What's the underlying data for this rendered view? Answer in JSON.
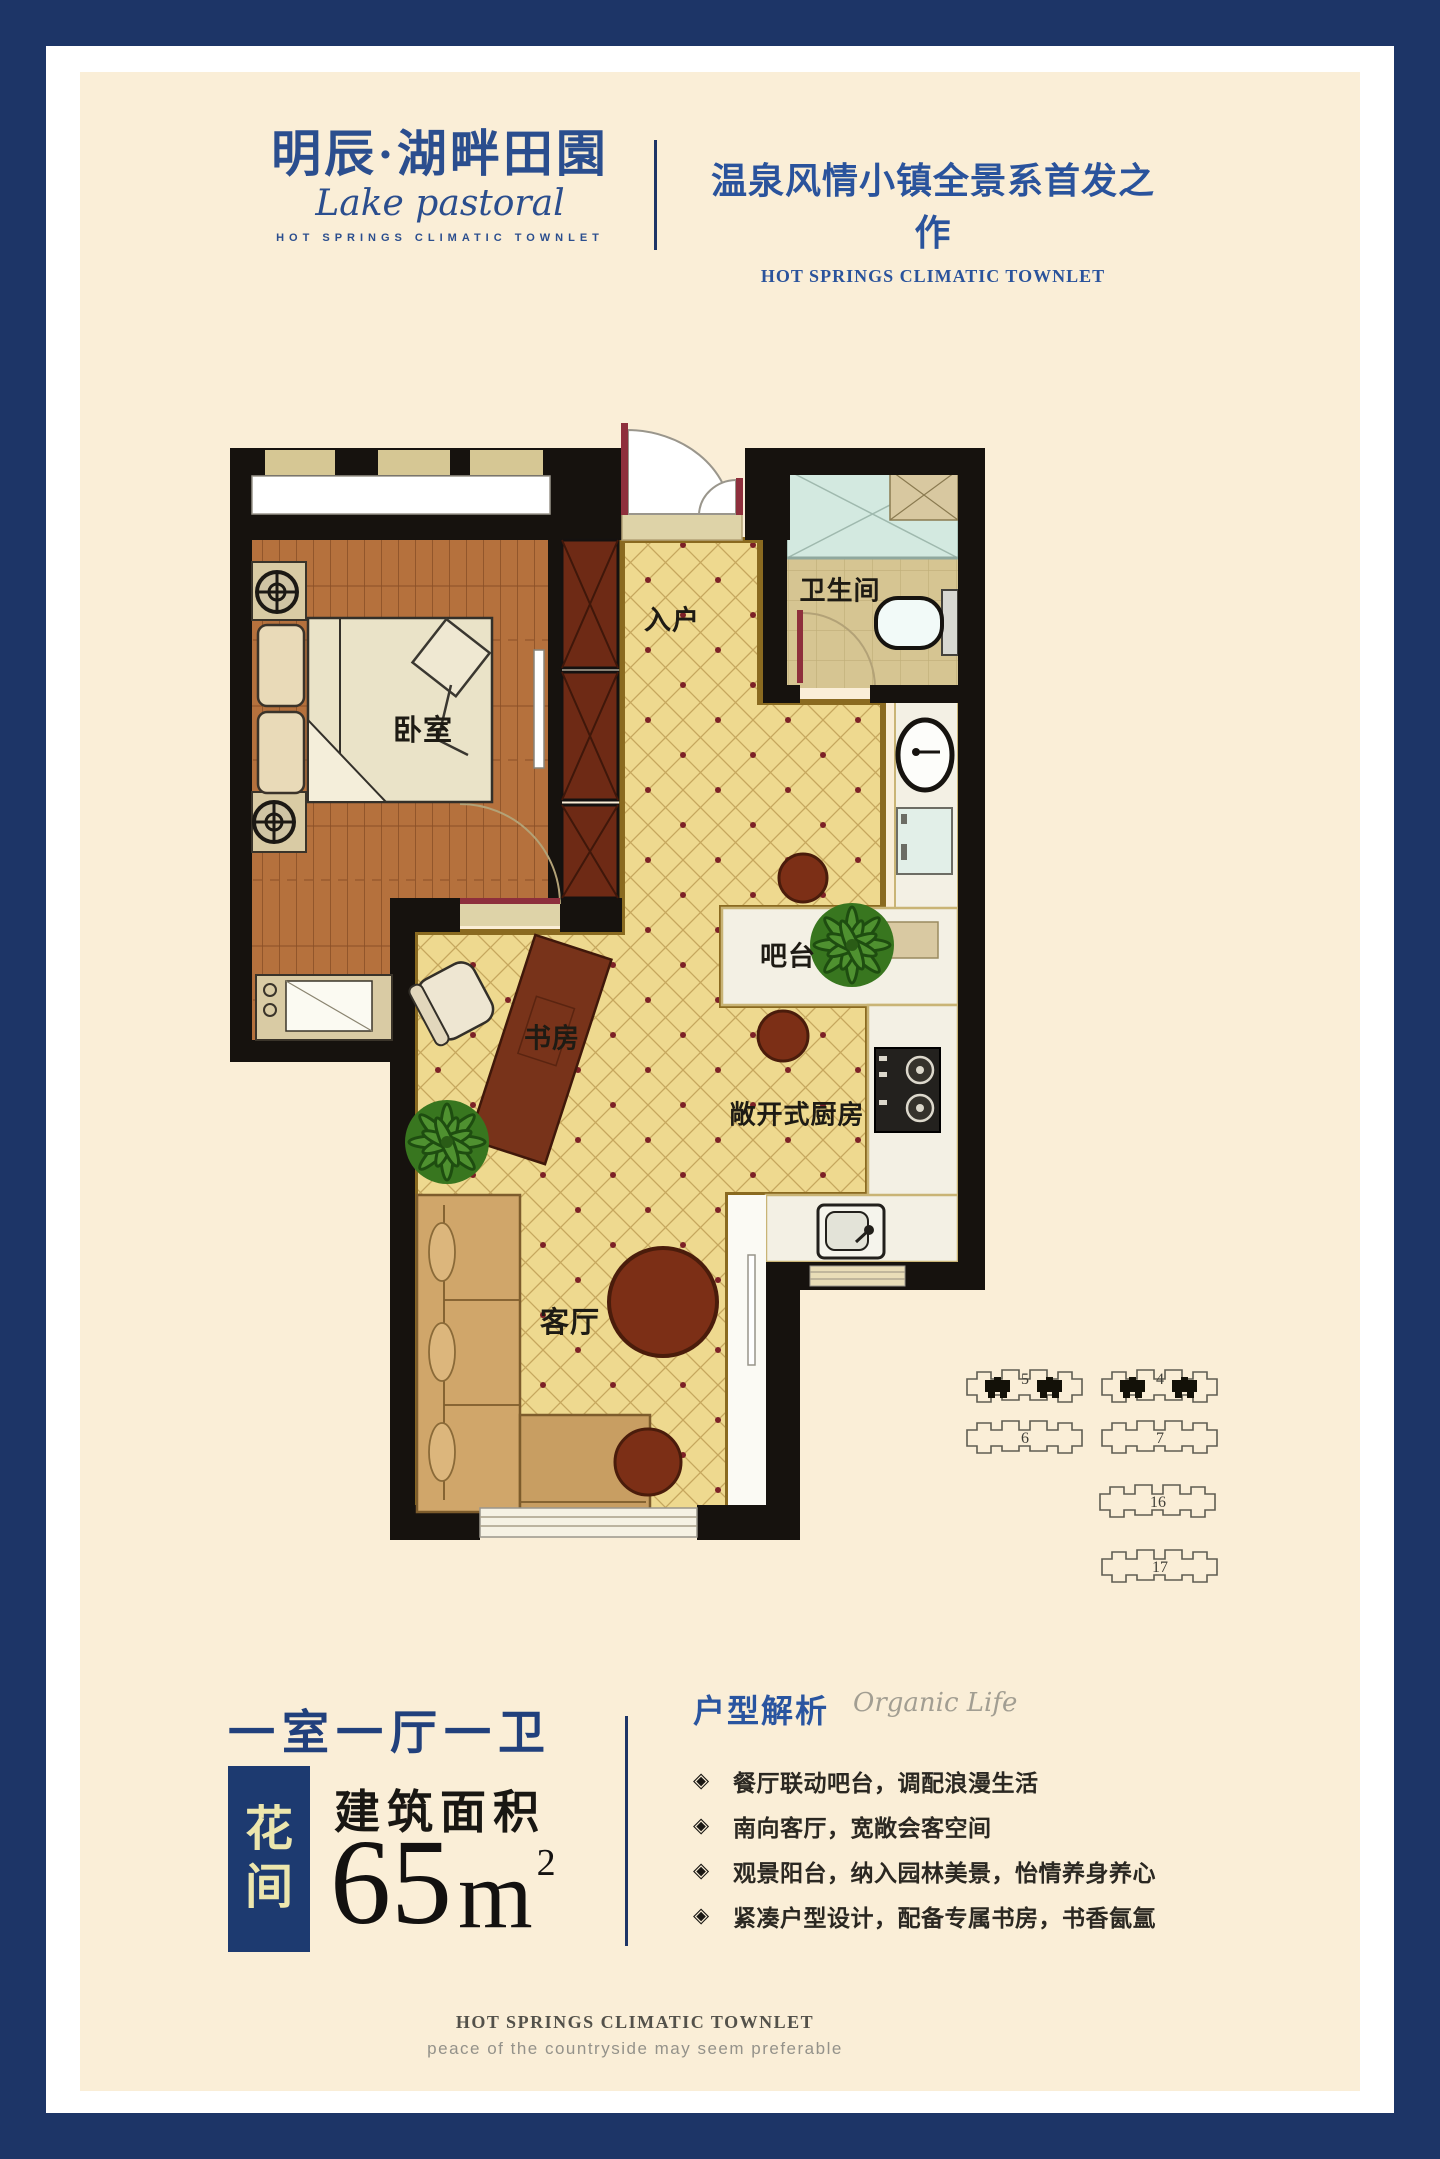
{
  "brand": {
    "logo_cn": "明辰·湖畔田園",
    "logo_script": "Lake pastoral",
    "logo_caption": "HOT SPRINGS CLIMATIC TOWNLET",
    "tagline_cn": "温泉风情小镇全景系首发之作",
    "tagline_en": "HOT SPRINGS CLIMATIC TOWNLET"
  },
  "floorplan": {
    "room_labels": {
      "bedroom": "卧室",
      "entry": "入户",
      "bathroom": "卫生间",
      "bar": "吧台",
      "study": "书房",
      "kitchen": "敞开式厨房",
      "living": "客厅"
    },
    "site_key": {
      "buildings": [
        "5",
        "4",
        "6",
        "7",
        "16",
        "17"
      ],
      "highlighted": [
        "5",
        "4"
      ]
    }
  },
  "unit_info": {
    "layout": "一室一厅一卫",
    "unit_name_chars": [
      "花",
      "间"
    ],
    "area_label": "建筑面积",
    "area_number": "65",
    "area_unit": "m",
    "area_exponent": "2"
  },
  "analysis": {
    "title": "户型解析",
    "watermark": "Organic Life",
    "bullet_icon": "◈",
    "bullets": [
      "餐厅联动吧台，调配浪漫生活",
      "南向客厅，宽敞会客空间",
      "观景阳台，纳入园林美景，怡情养身养心",
      "紧凑户型设计，配备专属书房，书香氤氲"
    ]
  },
  "footer": {
    "title_en": "HOT SPRINGS CLIMATIC TOWNLET",
    "subtitle_en": "peace of the countryside may seem preferable"
  },
  "colors": {
    "frame_navy": "#1d3567",
    "canvas_cream": "#faeed7",
    "brand_blue": "#2b4e8e",
    "tagline_blue": "#2a539c",
    "tile_yellow": "#eed98f",
    "wood_brown": "#b5713d",
    "wall_black": "#16120e",
    "accent_red_dot": "#7c2026",
    "gold_trim": "#8a6a20"
  }
}
